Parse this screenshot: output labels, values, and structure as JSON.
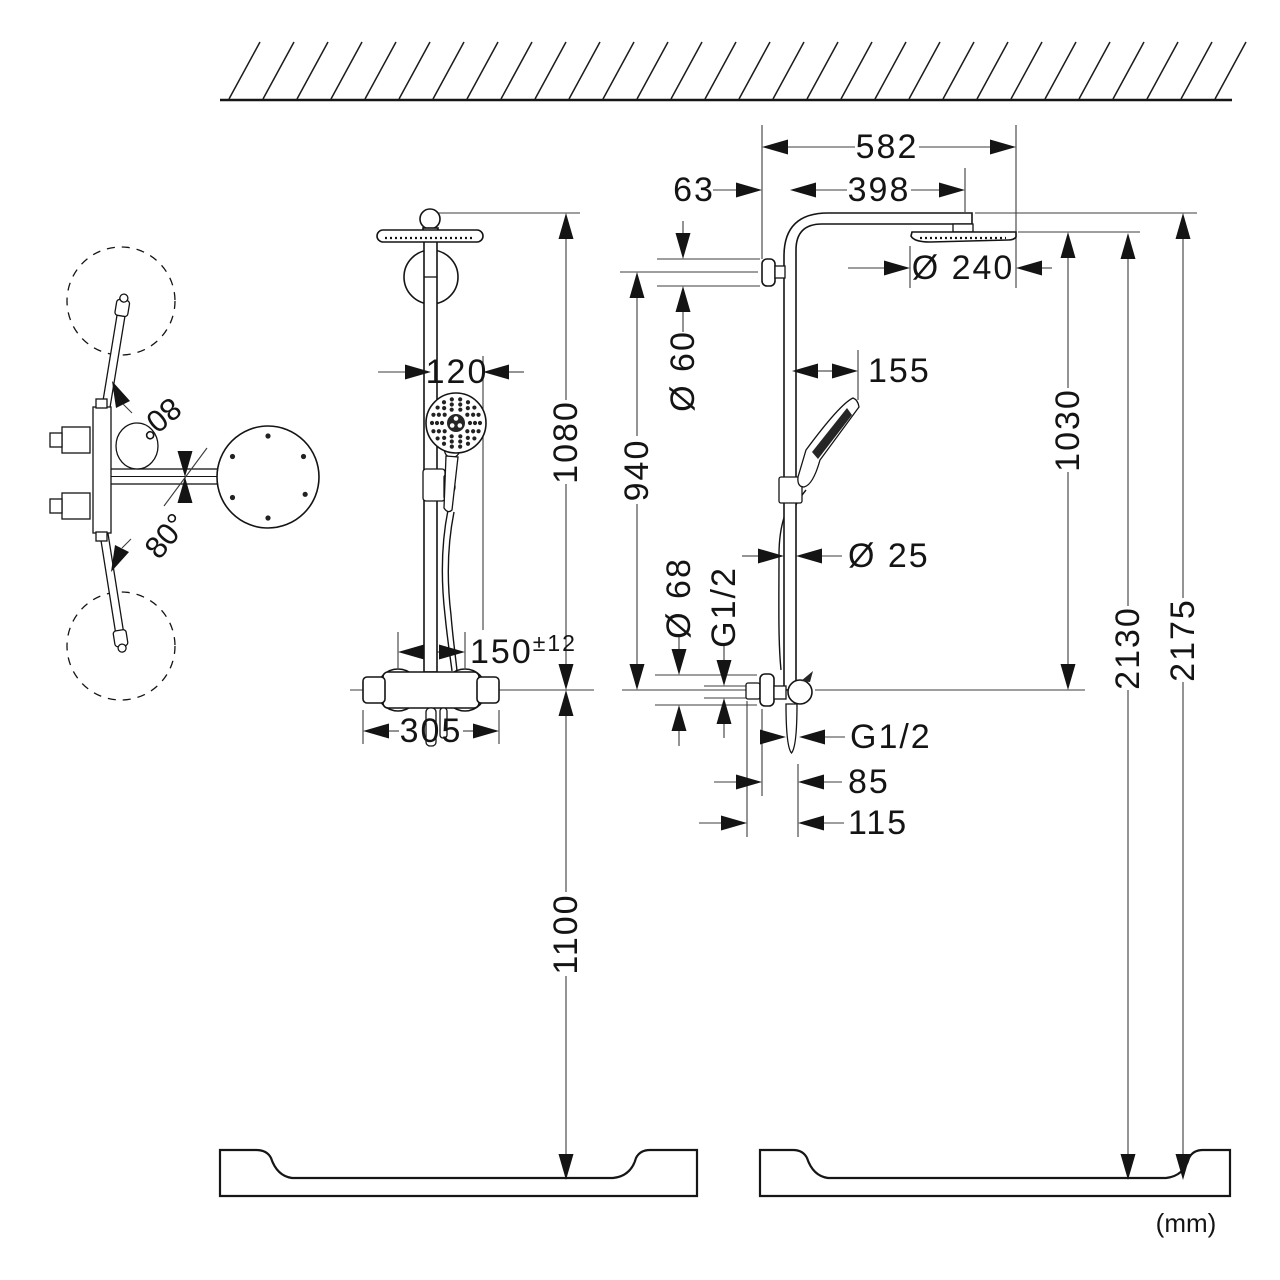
{
  "units_note": "(mm)",
  "top_view": {
    "swivel_upper": "80°",
    "swivel_lower": "80°"
  },
  "front_view": {
    "handshower_offset": "120",
    "bar_height_above_valve": "1080",
    "inlet_spacing": "150",
    "inlet_spacing_tolerance": "±12",
    "valve_width": "305",
    "valve_mounting_height": "1100"
  },
  "side_view": {
    "arm_overall": "582",
    "wall_to_bar": "63",
    "arm_projection": "398",
    "head_diameter": "Ø 240",
    "wall_union_diameter": "Ø 60",
    "bar_length_to_valve": "940",
    "handshower_projection": "155",
    "head_to_valve_height": "1030",
    "bar_diameter": "Ø 25",
    "escutcheon_diameter": "Ø 68",
    "inlet_thread": "G1/2",
    "outlet_thread": "G1/2",
    "outlet_offset": "85",
    "hose_offset": "115",
    "head_mounting_height": "2130",
    "arm_mounting_height": "2175"
  }
}
